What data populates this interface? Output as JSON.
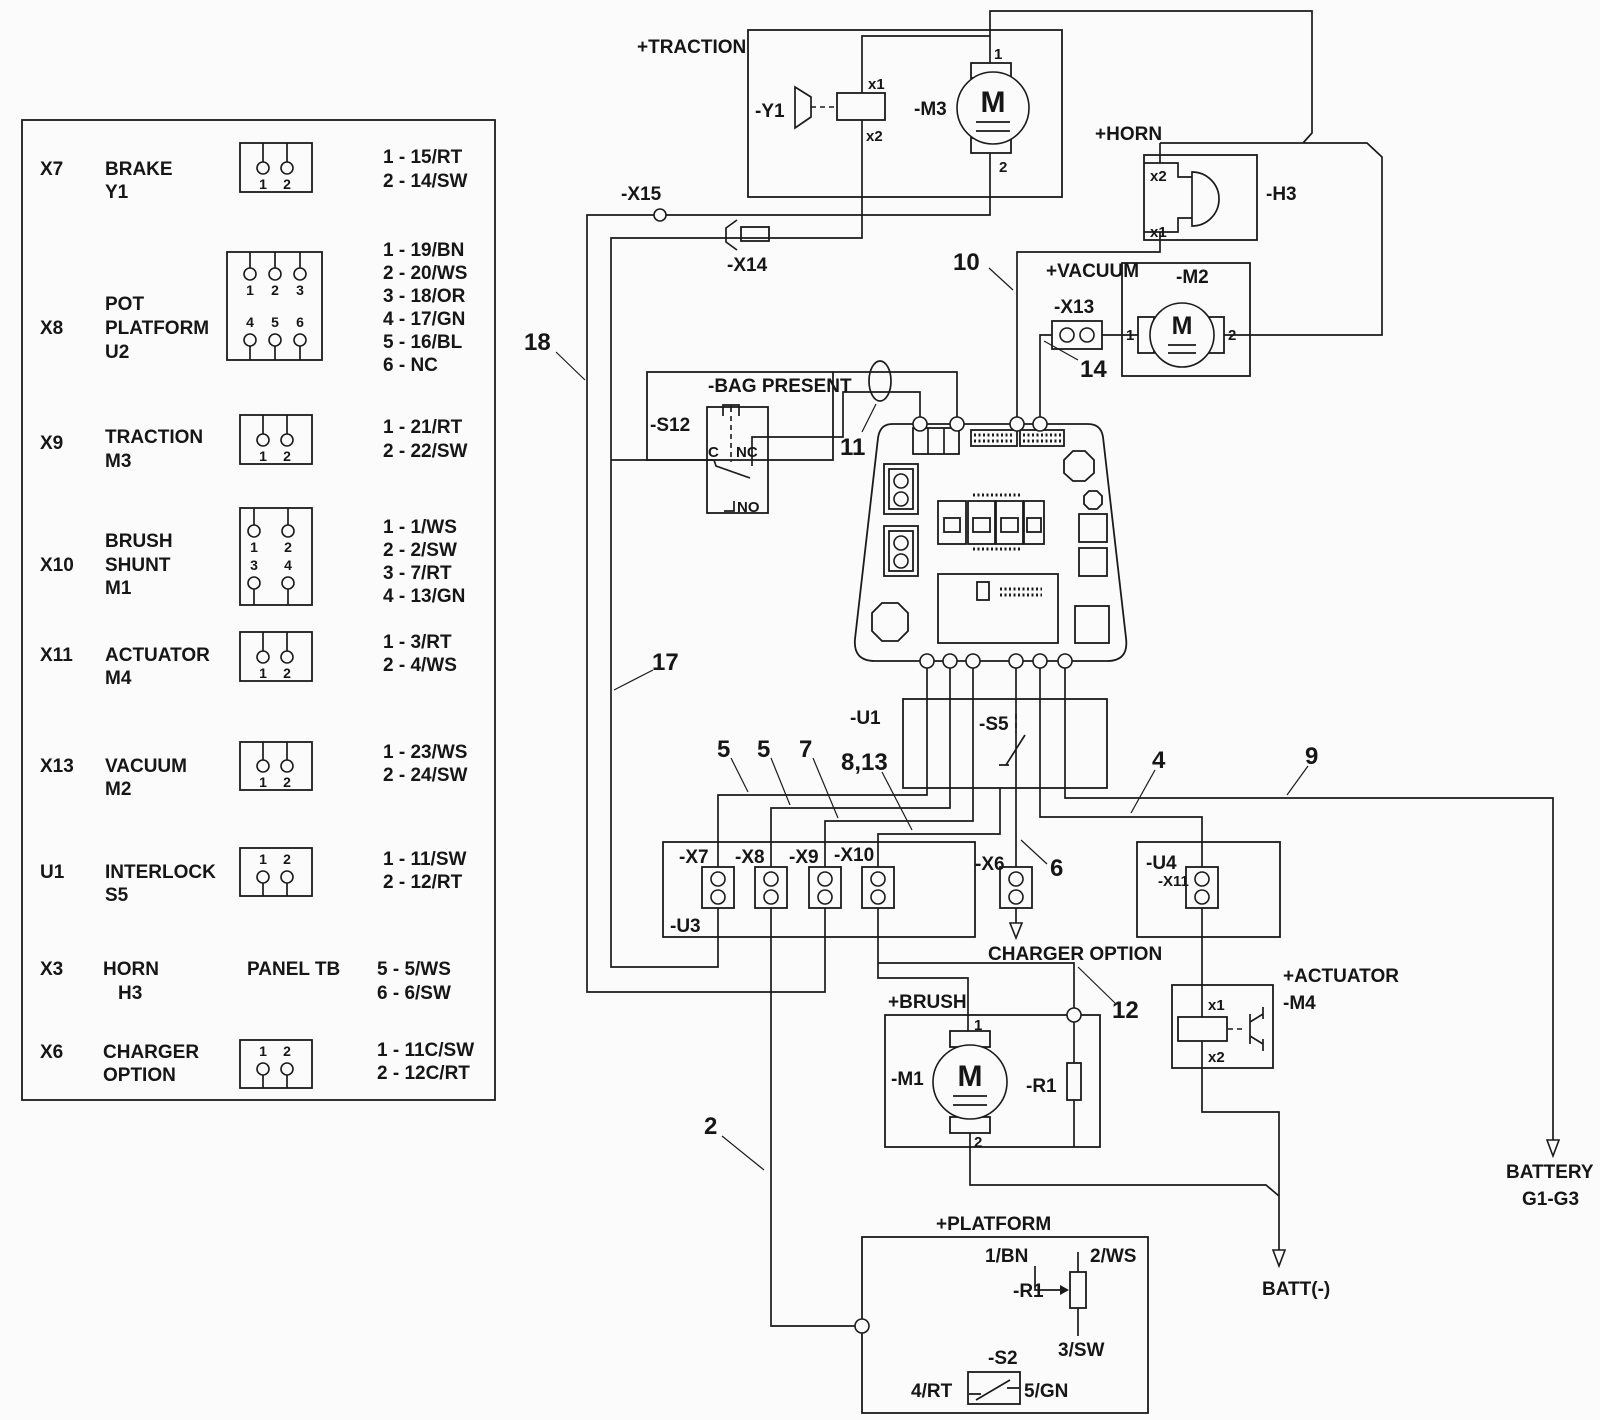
{
  "colors": {
    "line": "#1b1b1b",
    "background": "#fbfbfb"
  },
  "legend": {
    "icon_nums": [
      "1",
      "2",
      "3",
      "4",
      "5",
      "6"
    ],
    "rows": [
      {
        "id": "X7",
        "l1": "BRAKE",
        "l2": "Y1",
        "pins": [
          "1 - 15/RT",
          "2 - 14/SW"
        ]
      },
      {
        "id": "X8",
        "l1": "POT",
        "l2": "PLATFORM",
        "l3": "U2",
        "pins": [
          "1 - 19/BN",
          "2 - 20/WS",
          "3 - 18/OR",
          "4 - 17/GN",
          "5 - 16/BL",
          "6 - NC"
        ]
      },
      {
        "id": "X9",
        "l1": "TRACTION",
        "l2": "M3",
        "pins": [
          "1 - 21/RT",
          "2 - 22/SW"
        ]
      },
      {
        "id": "X10",
        "l1": "BRUSH",
        "l2": "SHUNT",
        "l3": "M1",
        "pins": [
          "1 - 1/WS",
          "2 - 2/SW",
          "3 - 7/RT",
          "4 - 13/GN"
        ]
      },
      {
        "id": "X11",
        "l1": "ACTUATOR",
        "l2": "M4",
        "pins": [
          "1 - 3/RT",
          "2 - 4/WS"
        ]
      },
      {
        "id": "X13",
        "l1": "VACUUM",
        "l2": "M2",
        "pins": [
          "1 - 23/WS",
          "2 - 24/SW"
        ]
      },
      {
        "id": "U1",
        "l1": "INTERLOCK",
        "l2": "S5",
        "pins": [
          "1 - 11/SW",
          "2 - 12/RT"
        ]
      },
      {
        "id": "X3",
        "l1": "HORN",
        "l2": "H3",
        "mid": "PANEL TB",
        "pins": [
          "5 - 5/WS",
          "6 - 6/SW"
        ]
      },
      {
        "id": "X6",
        "l1": "CHARGER",
        "l2": "OPTION",
        "pins": [
          "1 - 11C/SW",
          "2 - 12C/RT"
        ]
      }
    ]
  },
  "zones": {
    "traction": "+TRACTION",
    "horn": "+HORN",
    "vacuum": "+VACUUM",
    "bag": "-BAG PRESENT",
    "brush": "+BRUSH",
    "actuator": "+ACTUATOR",
    "platform": "+PLATFORM"
  },
  "components": {
    "y1": "-Y1",
    "m3": "-M3",
    "h3": "-H3",
    "m2": "-M2",
    "s12": "-S12",
    "u1": "-U1",
    "s5": "-S5",
    "u3": "-U3",
    "u4": "-U4",
    "m1": "-M1",
    "r1b": "-R1",
    "m4": "-M4",
    "r1p": "-R1",
    "s2": "-S2",
    "motor": "M"
  },
  "connectors": {
    "x15": "-X15",
    "x14": "-X14",
    "x13": "-X13",
    "x7": "-X7",
    "x8": "-X8",
    "x9": "-X9",
    "x10": "-X10",
    "x6": "-X6",
    "x11": "-X11"
  },
  "pins": {
    "x1": "x1",
    "x2": "x2",
    "n1": "1",
    "n2": "2",
    "c": "C",
    "nc": "NC",
    "no": "NO",
    "p1": "1/BN",
    "p2": "2/WS",
    "p3": "3/SW",
    "p4": "4/RT",
    "p5": "5/GN"
  },
  "wires": {
    "n2": "2",
    "n4": "4",
    "n5a": "5",
    "n5b": "5",
    "n6": "6",
    "n7": "7",
    "n813": "8,13",
    "n9": "9",
    "n10": "10",
    "n11": "11",
    "n12": "12",
    "n14": "14",
    "n17": "17",
    "n18": "18"
  },
  "terminals": {
    "charger": "CHARGER OPTION",
    "battery": "BATTERY",
    "range": "G1-G3",
    "battneg": "BATT(-)"
  }
}
